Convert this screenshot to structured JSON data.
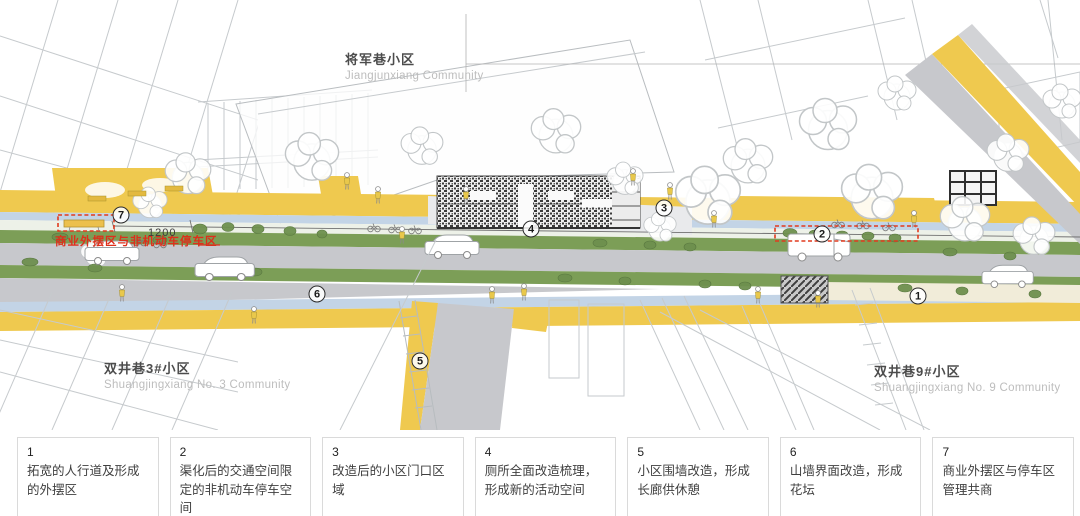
{
  "drawing": {
    "communities": {
      "top": {
        "zh": "将军巷小区",
        "en": "Jiangjunxiang Community"
      },
      "bottom_left": {
        "zh": "双井巷3#小区",
        "en": "Shuangjingxiang No. 3 Community"
      },
      "bottom_right": {
        "zh": "双井巷9#小区",
        "en": "Shuangjingxiang No. 9 Community"
      }
    },
    "red_annotation": "商业外摆区与非机动车停车区",
    "dimension_label": "1200",
    "markers": [
      {
        "n": "1",
        "x": 918,
        "y": 296
      },
      {
        "n": "2",
        "x": 822,
        "y": 234
      },
      {
        "n": "3",
        "x": 664,
        "y": 208
      },
      {
        "n": "4",
        "x": 531,
        "y": 229
      },
      {
        "n": "5",
        "x": 420,
        "y": 361
      },
      {
        "n": "6",
        "x": 317,
        "y": 294
      },
      {
        "n": "7",
        "x": 121,
        "y": 215
      }
    ],
    "colors": {
      "accent_red": "#DD2F1B",
      "pavement_yellow": "#EFC94F",
      "planting_green": "#7C9E57",
      "road_gray": "#C7C8CC",
      "awning_blue": "#C3D4E6",
      "cream": "#F1ECD9"
    }
  },
  "legend": {
    "items": [
      {
        "number": "1",
        "text": "拓宽的人行道及形成的外摆区"
      },
      {
        "number": "2",
        "text": "渠化后的交通空间限定的非机动车停车空间"
      },
      {
        "number": "3",
        "text": "改造后的小区门口区域"
      },
      {
        "number": "4",
        "text": "厕所全面改造梳理，形成新的活动空间"
      },
      {
        "number": "5",
        "text": "小区围墙改造，形成长廊供休憩"
      },
      {
        "number": "6",
        "text": "山墙界面改造，形成花坛"
      },
      {
        "number": "7",
        "text": "商业外摆区与停车区管理共商"
      }
    ]
  }
}
